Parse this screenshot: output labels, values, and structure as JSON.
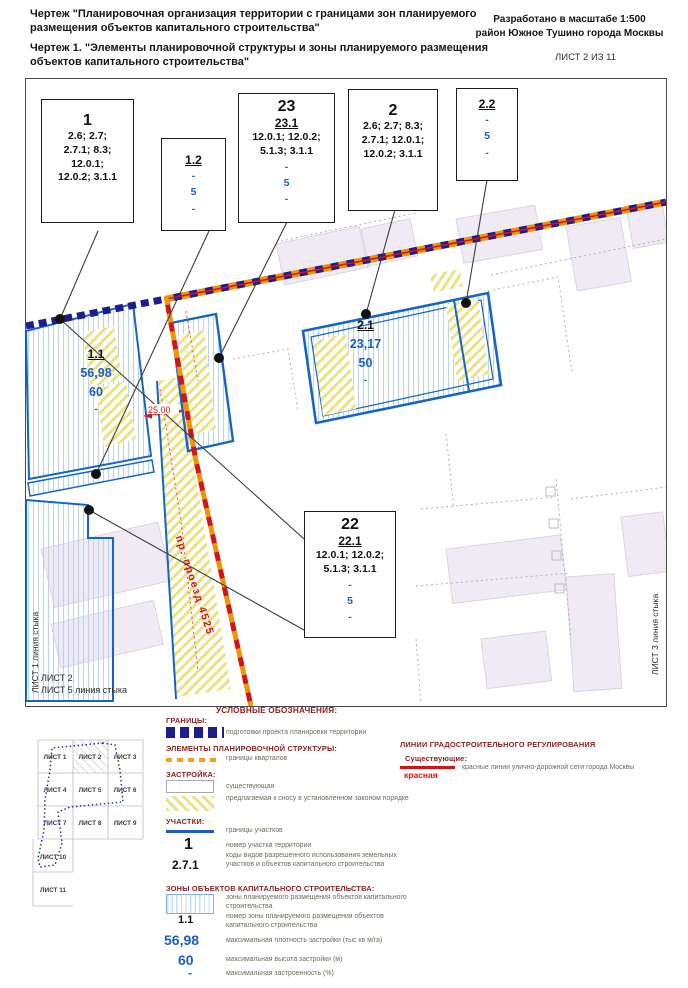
{
  "header": {
    "title1": "Чертеж \"Планировочная организация территории с границами зон планируемого размещения объектов капитального строительства\"",
    "title2": "Чертеж 1. \"Элементы планировочной структуры и зоны планируемого размещения объектов капитального строительства\"",
    "scale": "Разработано в масштабе 1:500",
    "district": "район Южное Тушино города Москвы",
    "sheet": "ЛИСТ 2 ИЗ 11"
  },
  "callouts": {
    "b1": {
      "num": "1",
      "c0": "2.6; 2.7;",
      "c1": "2.7.1; 8.3;",
      "c2": "12.0.1;",
      "c3": "12.0.2; 3.1.1"
    },
    "b12": {
      "num": "1.2",
      "v0": "-",
      "v1": "5",
      "v2": "-"
    },
    "b23": {
      "num": "23",
      "zone": "23.1",
      "c0": "12.0.1; 12.0.2;",
      "c1": "5.1.3; 3.1.1",
      "v0": "-",
      "v1": "5",
      "v2": "-"
    },
    "b2": {
      "num": "2",
      "c0": "2.6; 2.7; 8.3;",
      "c1": "2.7.1; 12.0.1;",
      "c2": "12.0.2; 3.1.1"
    },
    "b22s": {
      "num": "2.2",
      "v0": "-",
      "v1": "5",
      "v2": "-"
    },
    "b22": {
      "num": "22",
      "zone": "22.1",
      "c0": "12.0.1; 12.0.2;",
      "c1": "5.1.3; 3.1.1",
      "v0": "-",
      "v1": "5",
      "v2": "-"
    }
  },
  "map": {
    "zone11": {
      "num": "1.1",
      "density": "56,98",
      "height": "60",
      "cov": "-"
    },
    "zone21": {
      "num": "2.1",
      "density": "23,17",
      "height": "50",
      "cov": "-"
    },
    "dim": "25.00",
    "road": "пр. проезд 4525",
    "edge_left": "ЛИСТ 1 линия стыка",
    "edge_bottom_a": "ЛИСТ 2",
    "edge_bottom_b": "ЛИСТ 5 линия стыка",
    "edge_right": "ЛИСТ 3 линия стыка"
  },
  "legend": {
    "title": "УСЛОВНЫЕ ОБОЗНАЧЕНИЯ:",
    "granitsy": {
      "header": "ГРАНИЦЫ:",
      "item": "подготовки проекта планировки территории"
    },
    "elementy": {
      "header": "ЭЛЕМЕНТЫ ПЛАНИРОВОЧНОЙ СТРУКТУРЫ:",
      "item": "границы кварталов"
    },
    "zastroyka": {
      "header": "ЗАСТРОЙКА:",
      "existing": "существующая",
      "demolition": "предлагаемая к сносу в установленном законом порядке"
    },
    "uchastki": {
      "header": "УЧАСТКИ:",
      "borders": "границы участков",
      "number_symbol": "1",
      "number_label": "номер участка территории",
      "codes_symbol": "2.7.1",
      "codes_label": "коды видов разрешенного использования земельных участков и объектов капитального строительства"
    },
    "zony": {
      "header": "ЗОНЫ ОБЪЕКТОВ КАПИТАЛЬНОГО СТРОИТЕЛЬСТВА:",
      "zone_label": "зоны планируемого размещения объектов капитального строительства",
      "number_symbol": "1.1",
      "number_label": "номер зоны планируемого размещения объектов капитального строительства",
      "density_symbol": "56,98",
      "density_label": "максимальная плотность застройки (тыс кв м/га)",
      "height_symbol": "60",
      "height_label": "максимальная высота застройки (м)",
      "coverage_symbol": "-",
      "coverage_label": "максимальная застроенность  (%)"
    },
    "lines": {
      "header": "ЛИНИИ ГРАДОСТРОИТЕЛЬНОГО РЕГУЛИРОВАНИЯ",
      "existing": "Существующие:",
      "red_symbol": "красная",
      "red_label": "красные линии улично-дорожной сети города Москвы"
    }
  },
  "sheets": {
    "cells": [
      "ЛИСТ 1",
      "ЛИСТ 2",
      "ЛИСТ 3",
      "ЛИСТ 4",
      "ЛИСТ 5",
      "ЛИСТ 6",
      "ЛИСТ 7",
      "ЛИСТ 8",
      "ЛИСТ 9",
      "ЛИСТ 10",
      "ЛИСТ 11"
    ]
  },
  "colors": {
    "parcel_blue": "#1565c6",
    "value_blue": "#1b5fc4",
    "boundary_navy": "#1d1d8f",
    "quarter_orange": "#ee9500",
    "red_line": "#d41414",
    "legend_header": "#8c2020",
    "hatch_blue": "#b9d4ea",
    "hatch_yellow": "#ebe288"
  }
}
